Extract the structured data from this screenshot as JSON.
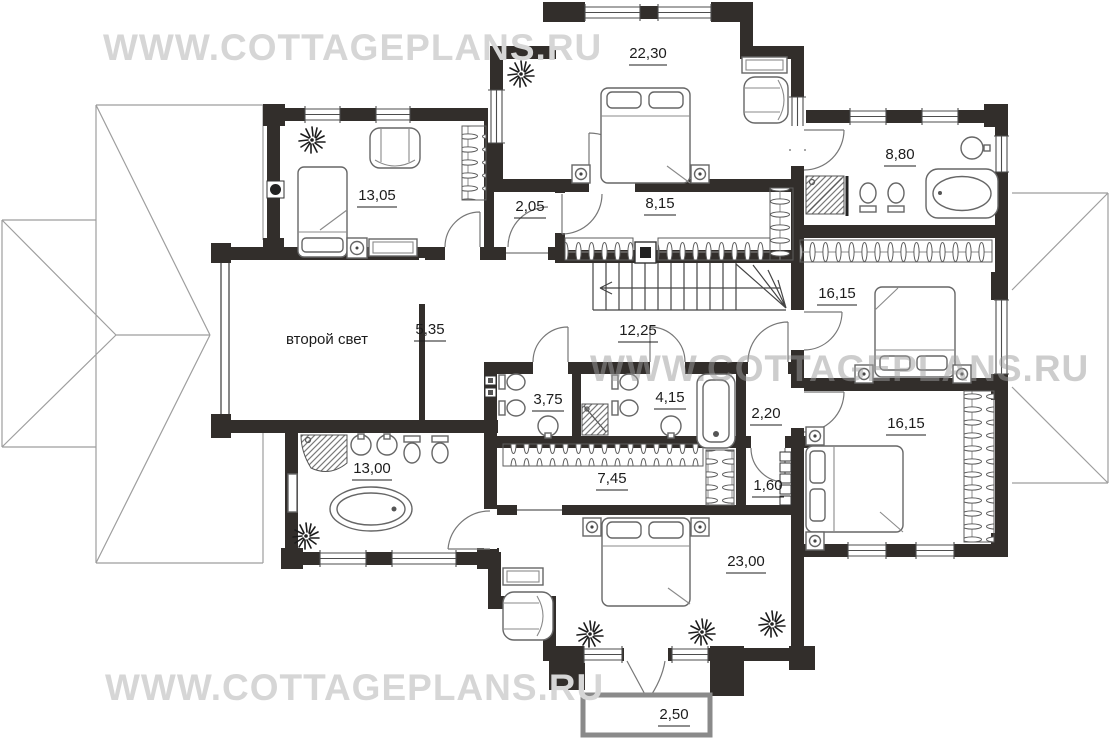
{
  "watermark_text": "WWW.COTTAGEPLANS.RU",
  "plan_labels": {
    "bedroom_top": "22,30",
    "child_room": "13,05",
    "wardrobe_hall": "2,05",
    "upper_corridor": "8,15",
    "master_bathroom": "8,80",
    "bedroom_east": "16,15",
    "gallery_hall": "5,35",
    "stair_hall": "12,25",
    "bathroom_left": "3,75",
    "bathroom_right": "4,15",
    "vestibule": "2,20",
    "bedroom_southeast": "16,15",
    "bathroom_south": "13,00",
    "lower_corridor": "7,45",
    "closet": "1,60",
    "bedroom_south": "23,00",
    "balcony": "2,50",
    "second_light": "второй свет"
  }
}
